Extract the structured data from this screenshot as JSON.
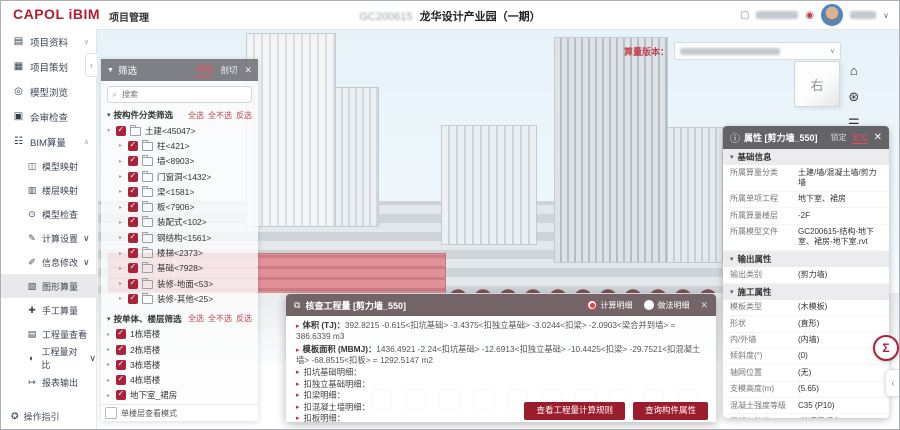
{
  "icons": {
    "funnel": "▼",
    "search": "⌕",
    "close": "✕",
    "caret_down": "▾",
    "caret_right": "▸",
    "chev_down": "∨",
    "chev_up": "∧",
    "chev_left": "‹",
    "sigma": "Σ",
    "home": "⌂",
    "orbit": "⊛",
    "legend": "☰",
    "info": "ⓘ",
    "window": "⧉",
    "square": "▢",
    "service": "◉"
  },
  "header": {
    "logo_primary": "CAPOL",
    "logo_secondary": "iBIM",
    "module": "项目管理",
    "project_code": "GC200615",
    "project_title": "龙华设计产业园（一期）"
  },
  "sidebar": {
    "items": [
      {
        "icon": "▤",
        "label": "项目资料"
      },
      {
        "icon": "▦",
        "label": "项目策划"
      },
      {
        "icon": "◎",
        "label": "模型浏览"
      },
      {
        "icon": "▣",
        "label": "会审检查"
      },
      {
        "icon": "☷",
        "label": "BIM算量"
      }
    ],
    "sub_items": [
      {
        "icon": "◫",
        "label": "模型映射"
      },
      {
        "icon": "▥",
        "label": "楼层映射"
      },
      {
        "icon": "⊙",
        "label": "模型检查"
      },
      {
        "icon": "✎",
        "label": "计算设置"
      },
      {
        "icon": "✐",
        "label": "信息修改"
      },
      {
        "icon": "▧",
        "label": "图形算量"
      },
      {
        "icon": "✚",
        "label": "手工算量"
      },
      {
        "icon": "▤",
        "label": "工程量查看"
      },
      {
        "icon": "◐",
        "label": "工程量对比"
      },
      {
        "icon": "↦",
        "label": "报表输出"
      }
    ],
    "footer": "操作指引"
  },
  "viewport": {
    "version_label": "算量版本：",
    "cube_face": "右"
  },
  "filter": {
    "title": "筛选",
    "tab_visibility": "显隐",
    "tab_section": "剖切",
    "search_placeholder": "搜索",
    "group1_title": "按构件分类筛选",
    "link_all": "全选",
    "link_none": "全不选",
    "link_invert": "反选",
    "tree1": [
      {
        "label": "土建<45047>"
      },
      {
        "label": "柱<421>"
      },
      {
        "label": "墙<8903>"
      },
      {
        "label": "门窗洞<1432>"
      },
      {
        "label": "梁<1581>"
      },
      {
        "label": "板<7906>"
      },
      {
        "label": "装配式<102>"
      },
      {
        "label": "钢结构<1561>"
      },
      {
        "label": "楼梯<2373>"
      },
      {
        "label": "基础<7928>"
      },
      {
        "label": "装修-地面<53>"
      },
      {
        "label": "装修-其他<25>"
      }
    ],
    "group2_title": "按单体、楼层筛选",
    "tree2": [
      {
        "label": "1栋塔楼"
      },
      {
        "label": "2栋塔楼"
      },
      {
        "label": "3栋塔楼"
      },
      {
        "label": "4栋塔楼"
      },
      {
        "label": "地下室_裙房"
      }
    ],
    "footer_checkbox": "单楼层查看模式"
  },
  "properties": {
    "title": "属性 [剪力墙_550]",
    "link_lock": "锁定",
    "link_locate": "定位",
    "sections": [
      {
        "title": "基础信息",
        "rows": [
          {
            "k": "所属算量分类",
            "v": "土建/墙/混凝土墙/剪力墙"
          },
          {
            "k": "所属单项工程",
            "v": "地下室、裙房"
          },
          {
            "k": "所属算量楼层",
            "v": "-2F"
          },
          {
            "k": "所属模型文件",
            "v": "GC200615-结构-地下室、裙房-地下室.rvt"
          }
        ]
      },
      {
        "title": "输出属性",
        "rows": [
          {
            "k": "输出类别",
            "v": "(剪力墙)"
          }
        ]
      },
      {
        "title": "施工属性",
        "rows": [
          {
            "k": "模板类型",
            "v": "(木模板)"
          },
          {
            "k": "形状",
            "v": "(直形)"
          },
          {
            "k": "内/外墙",
            "v": "(内墙)"
          },
          {
            "k": "倾斜度(°)",
            "v": "(0)"
          },
          {
            "k": "轴网位置",
            "v": "(无)"
          },
          {
            "k": "支模高度(m)",
            "v": "(5.65)"
          },
          {
            "k": "混凝土强度等级",
            "v": "C35 (P10)"
          },
          {
            "k": "混凝土种类",
            "v": "(普通混凝土)"
          }
        ]
      },
      {
        "title": "钢筋信息",
        "rows": []
      }
    ]
  },
  "dialog": {
    "title": "核查工程量 [剪力墙_550]",
    "radio_calc": "计算明细",
    "radio_method": "做法明细",
    "line1_label": "体积 (TJ)：",
    "line1_value": "392.8215 -0.615<扣坑基础> -3.4375<扣独立基础> -3.0244<扣梁> -2.0903<梁合并到墙> = 386.6339 m3",
    "line2_label": "模板面积 (MBMJ)：",
    "line2_value": "1436.4921 -2.24<扣坑基础> -12.6913<扣独立基础> -10.4425<扣梁> -29.7521<扣混凝土墙> -68.8515<扣板> = 1292.5147 m2",
    "expand_items": [
      {
        "label": "扣坑基础明细："
      },
      {
        "label": "扣独立基础明细："
      },
      {
        "label": "扣梁明细："
      },
      {
        "label": "扣混凝土墙明细："
      },
      {
        "label": "扣板明细："
      }
    ],
    "btn_rules": "查看工程量计算规则",
    "btn_props": "查询构件属性"
  }
}
